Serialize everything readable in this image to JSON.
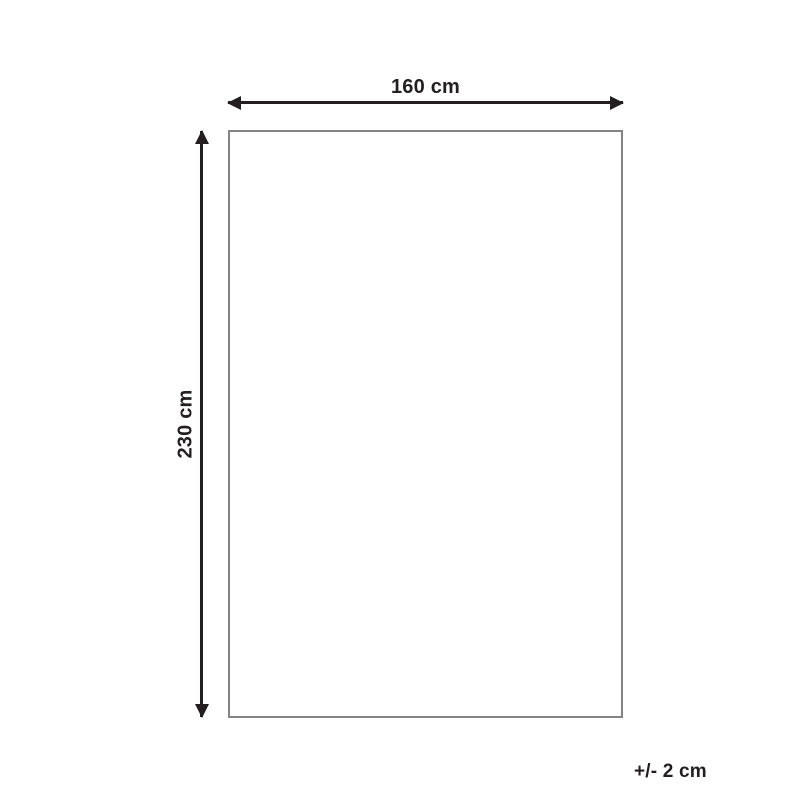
{
  "diagram": {
    "type": "product-dimension-diagram",
    "width_label": "160 cm",
    "height_label": "230 cm",
    "tolerance_label": "+/- 2 cm"
  },
  "colors": {
    "arrow": "#231f20",
    "rect_border": "#848484",
    "background": "#ffffff",
    "text": "#231f20"
  }
}
